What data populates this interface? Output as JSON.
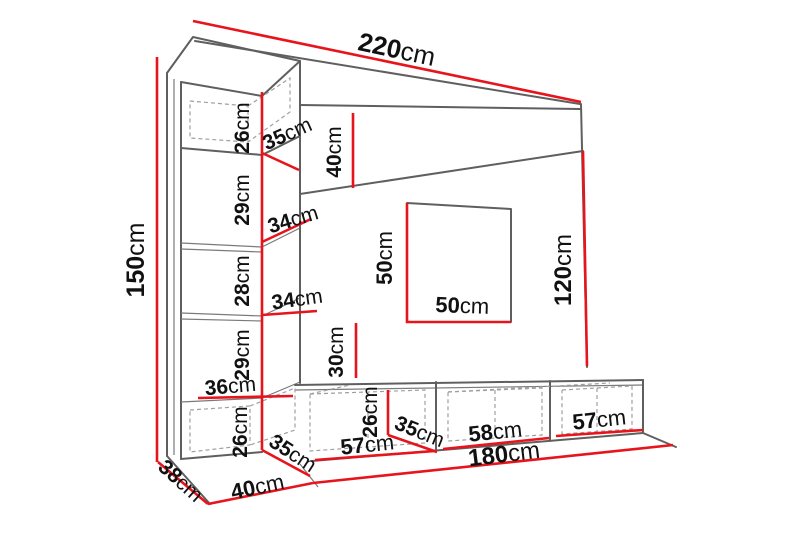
{
  "diagram": {
    "kind": "furniture-dimension-drawing",
    "subject": "TV wall unit with tall side column, header panel, open niche and TV stand",
    "unit": "cm",
    "colors": {
      "dimension_line": "#e8141c",
      "outline": "#5f5f5f",
      "hidden_edge": "#9f9f9f",
      "text": "#111111",
      "background": "#ffffff"
    },
    "dims": {
      "totalWidth": {
        "v": "220",
        "u": "cm"
      },
      "columnHeight": {
        "v": "150",
        "u": "cm"
      },
      "topCabinetHeight": {
        "v": "26",
        "u": "cm"
      },
      "topCabinetDepth": {
        "v": "35",
        "u": "cm"
      },
      "headerHeight": {
        "v": "40",
        "u": "cm"
      },
      "shelfGap1": {
        "v": "29",
        "u": "cm"
      },
      "shelfWidth1": {
        "v": "34",
        "u": "cm"
      },
      "shelfGap2": {
        "v": "28",
        "u": "cm"
      },
      "shelfWidth2": {
        "v": "34",
        "u": "cm"
      },
      "shelfGap3": {
        "v": "29",
        "u": "cm"
      },
      "shelfWidth3": {
        "v": "36",
        "u": "cm"
      },
      "lowerCabinetHeight": {
        "v": "26",
        "u": "cm"
      },
      "lowerCabinetDepth": {
        "v": "35",
        "u": "cm"
      },
      "openingHeight": {
        "v": "50",
        "u": "cm"
      },
      "openingWidth": {
        "v": "50",
        "u": "cm"
      },
      "rightPanelHeight": {
        "v": "120",
        "u": "cm"
      },
      "belowOpening": {
        "v": "30",
        "u": "cm"
      },
      "standHeight": {
        "v": "26",
        "u": "cm"
      },
      "standDepth": {
        "v": "35",
        "u": "cm"
      },
      "standSection1": {
        "v": "57",
        "u": "cm"
      },
      "standSection2": {
        "v": "58",
        "u": "cm"
      },
      "standSection3": {
        "v": "57",
        "u": "cm"
      },
      "standTotalWidth": {
        "v": "180",
        "u": "cm"
      },
      "floorDepth": {
        "v": "40",
        "u": "cm"
      },
      "columnSideDepth": {
        "v": "38",
        "u": "cm"
      }
    }
  }
}
